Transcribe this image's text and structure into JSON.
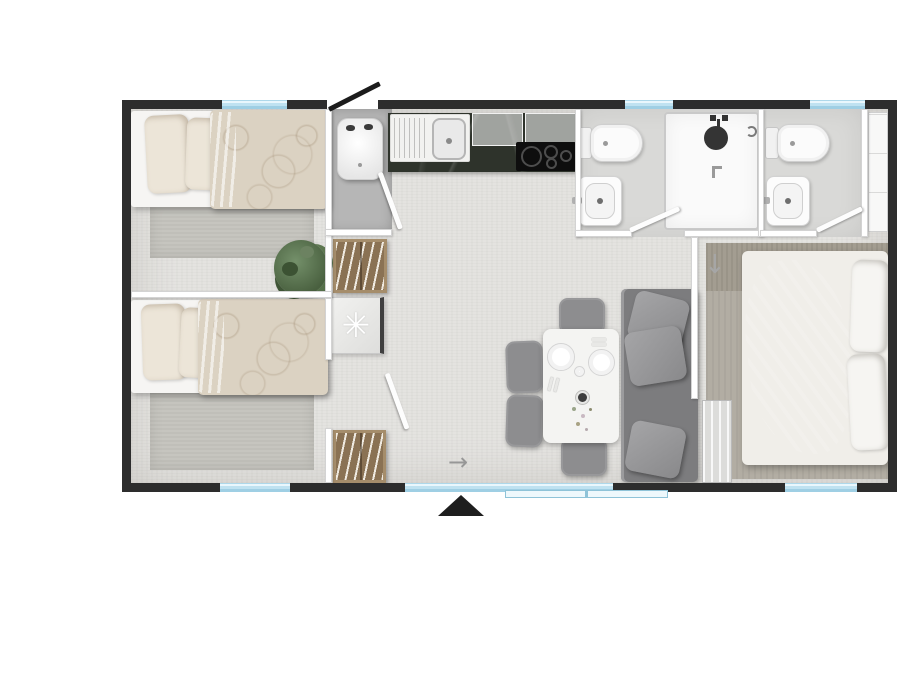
{
  "plan": {
    "type": "mobile-home-floor-plan",
    "colors": {
      "wall": "#2d2d2d",
      "window_glass": "#bfe2f1",
      "floor": "#e4e3e0",
      "floor_bath": "#d9d9d7",
      "floor_closet": "#b6b6b6",
      "wood": "#8a7254",
      "sofa": "#7c7c7e",
      "chair": "#8d8d8f",
      "rug": "#c6c5bf",
      "rug_master": "#b2ada3",
      "duvet": "#dbd2c2",
      "door_black": "#1c1c1c"
    },
    "symbols": {
      "optional_appliance": "✳",
      "flow_arrow_right": "→",
      "sliding_door_arrow_down": "↓",
      "entrance_marker": "▲"
    },
    "rooms": [
      {
        "name": "bedroom-top-left",
        "furniture": [
          "single-bed",
          "pillows",
          "rug",
          "plant",
          "hanger-wardrobe"
        ]
      },
      {
        "name": "bedroom-bottom-left",
        "furniture": [
          "single-bed",
          "pillows",
          "rug",
          "hanger-wardrobe",
          "optional-appliance-cabinet"
        ]
      },
      {
        "name": "entrance-hall",
        "furniture": [
          "water-heater"
        ]
      },
      {
        "name": "kitchen",
        "furniture": [
          "sink-with-drainer",
          "hob-4-burners",
          "upper-cabinets",
          "dark-worktop"
        ]
      },
      {
        "name": "shower-room",
        "furniture": [
          "toilet",
          "washbasin",
          "shower-enclosure"
        ]
      },
      {
        "name": "wc",
        "furniture": [
          "toilet",
          "washbasin"
        ]
      },
      {
        "name": "living-dining",
        "furniture": [
          "dining-table",
          "plates",
          "chairs-x4",
          "sofa",
          "cushions-x3"
        ]
      },
      {
        "name": "master-bedroom",
        "furniture": [
          "double-bed",
          "pillows",
          "rug",
          "tall-wardrobe",
          "sliding-door-panel"
        ]
      }
    ],
    "openings": {
      "windows_top": 3,
      "windows_bottom": 3,
      "entrance_door": "top, black leaf open outward",
      "patio_sliding_door": "bottom center-right",
      "interior_doors": 4
    }
  }
}
